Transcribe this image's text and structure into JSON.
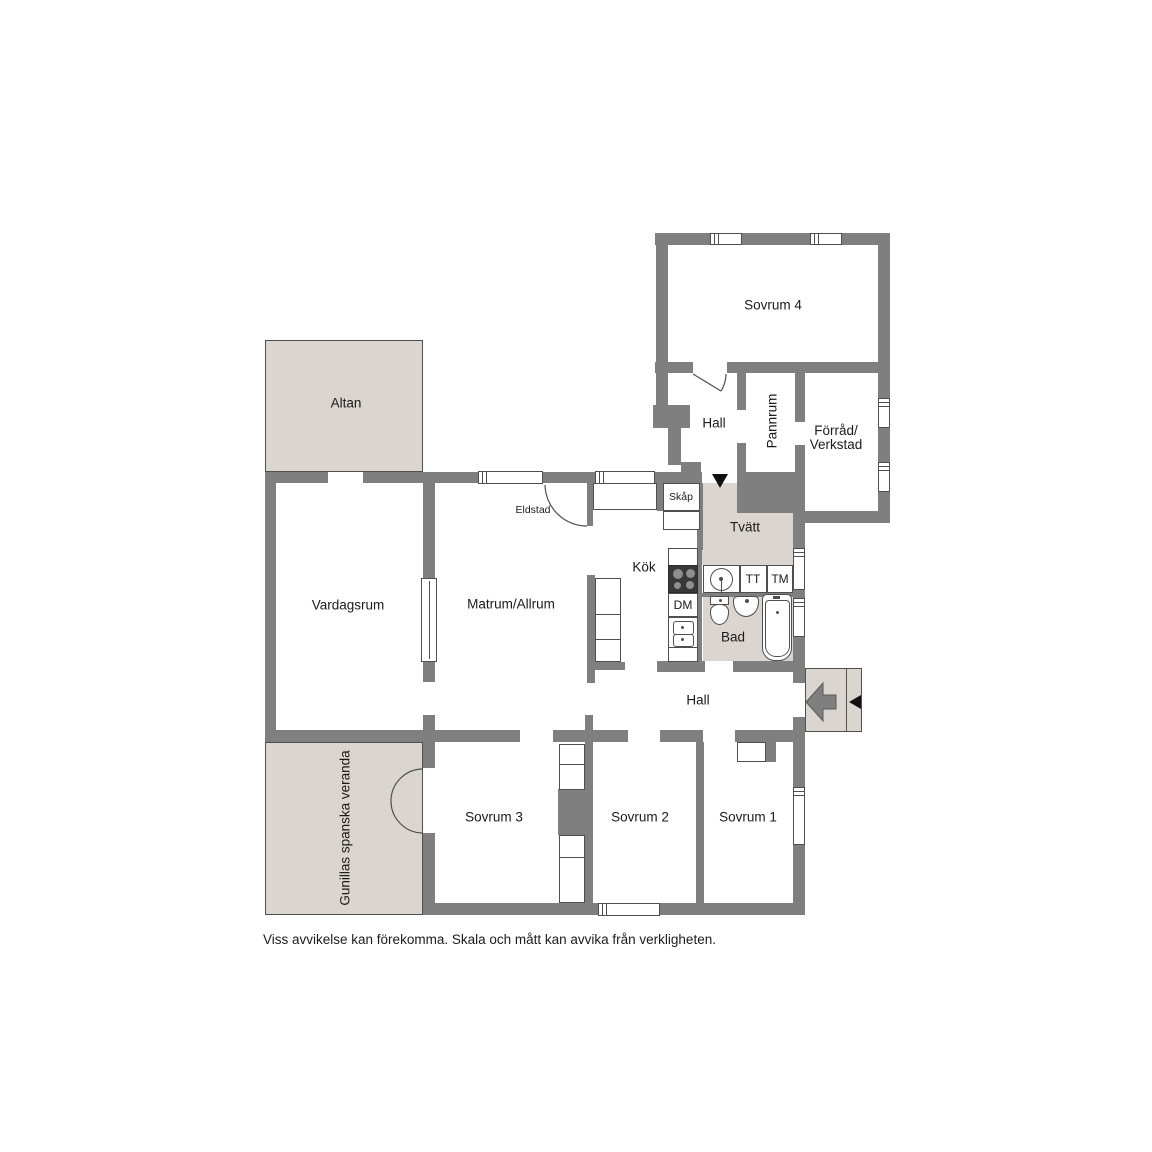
{
  "colors": {
    "wall": "#7f7f7f",
    "line": "#4f4f4f",
    "outdoor_floor": "#dad5ce",
    "stove": "#383838"
  },
  "rooms": {
    "sovrum4": "Sovrum 4",
    "hall_upper": "Hall",
    "pannrum": "Pannrum",
    "forrad_line1": "Förråd/",
    "forrad_line2": "Verkstad",
    "altan": "Altan",
    "vardagsrum": "Vardagsrum",
    "matrum": "Matrum/Allrum",
    "kok": "Kök",
    "tvatt": "Tvätt",
    "bad": "Bad",
    "hall_main": "Hall",
    "sovrum3": "Sovrum 3",
    "sovrum2": "Sovrum 2",
    "sovrum1": "Sovrum 1",
    "veranda": "Gunillas spanska veranda"
  },
  "fixtures": {
    "skap": "Skåp",
    "eldstad": "Eldstad",
    "dm": "DM",
    "tt": "TT",
    "tm": "TM"
  },
  "icons": {
    "entrance_arrow": "left-arrow",
    "entrance_marker": "left-triangle",
    "laundry_entrance_marker": "down-triangle"
  },
  "footer": {
    "disclaimer": "Viss avvikelse kan förekomma. Skala och mått kan avvika från verkligheten."
  }
}
